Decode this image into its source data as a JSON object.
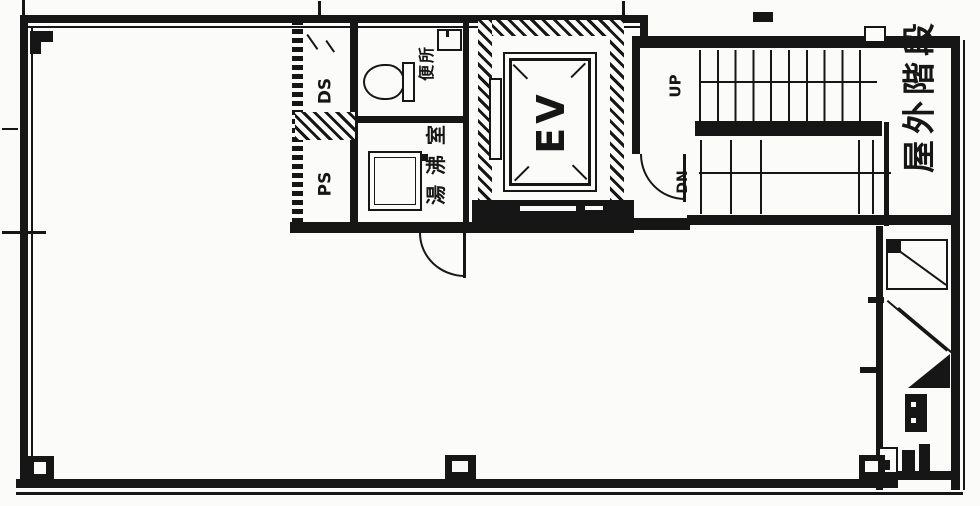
{
  "floor_plan": {
    "labels": {
      "duct_shaft": "DS",
      "pipe_shaft": "PS",
      "toilet": "便所",
      "kitchenette": "湯沸室",
      "elevator": "EV",
      "stair_up": "UP",
      "stair_down": "DN",
      "outdoor_staircase": "屋外階段"
    },
    "colors": {
      "ink": "#161616",
      "paper": "#fbfbfa"
    }
  }
}
